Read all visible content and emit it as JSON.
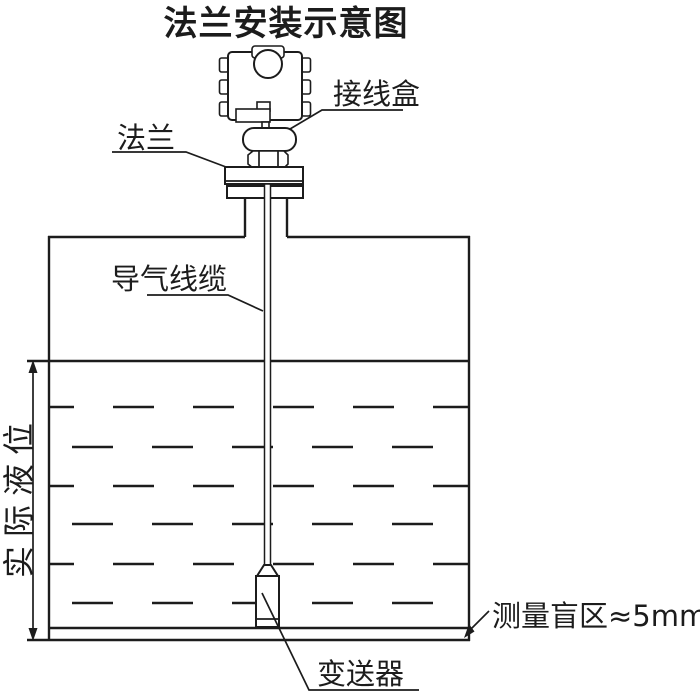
{
  "title": "法兰安装示意图",
  "labels": {
    "junction_box": "接线盒",
    "flange": "法兰",
    "air_cable": "导气线缆",
    "actual_level": "实际液位",
    "blind_zone": "测量盲区≈5mm",
    "transmitter": "变送器"
  },
  "colors": {
    "line": "#1c1c1c",
    "background": "#ffffff"
  }
}
